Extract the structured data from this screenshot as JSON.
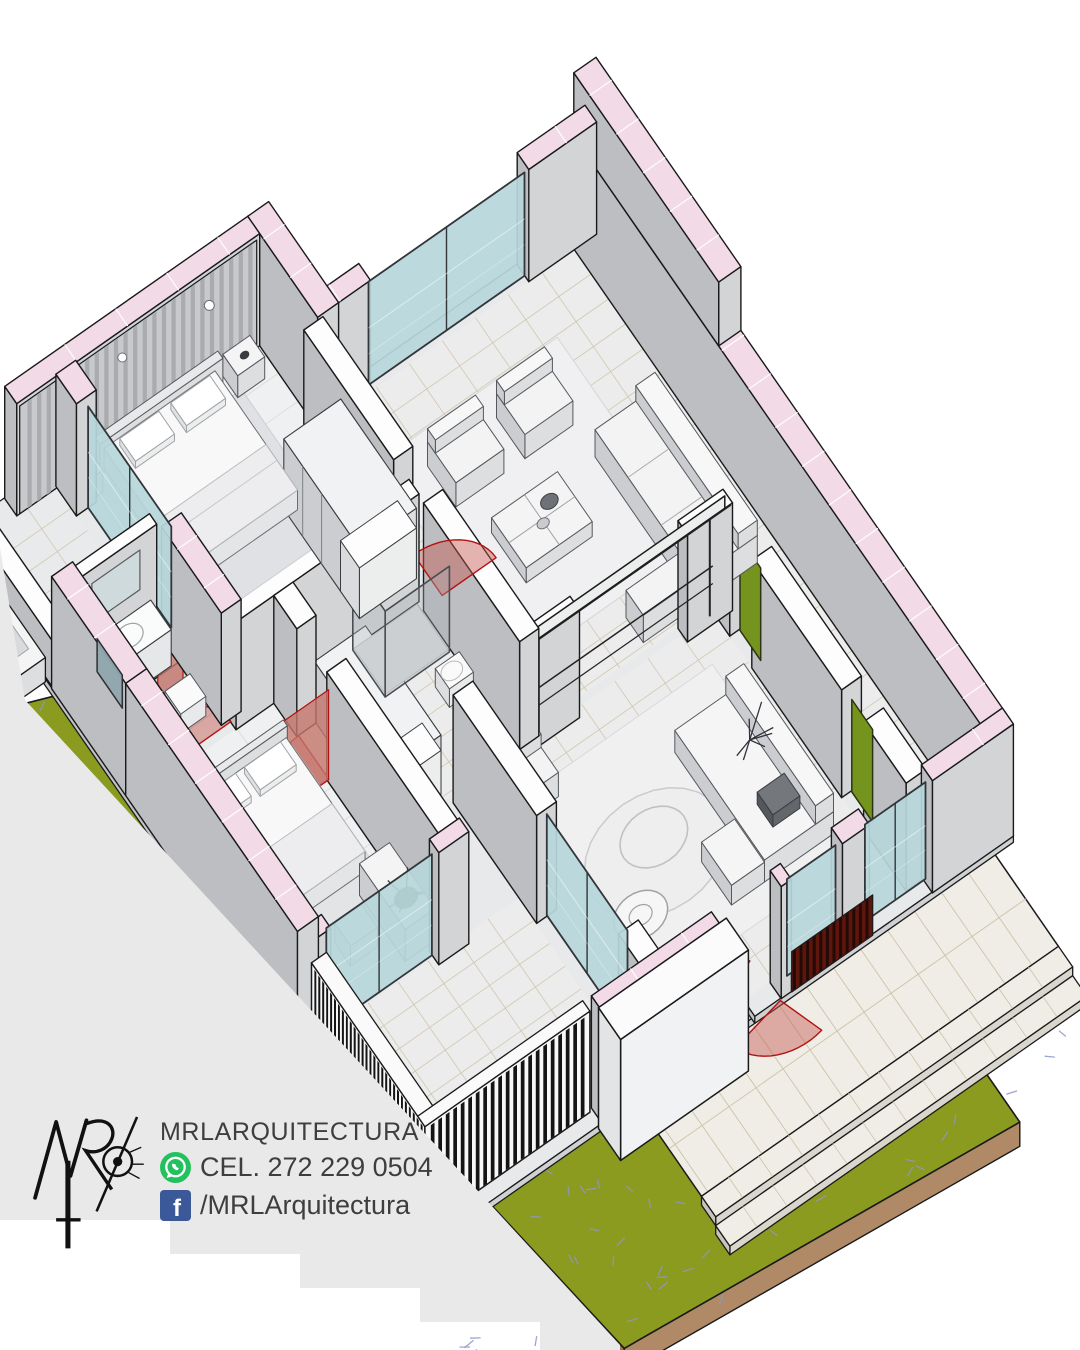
{
  "brand": {
    "logo_monogram": "MR",
    "name": "MRLARQUITECTURA",
    "phone": "CEL. 272 229 0504",
    "facebook": "/MRLArquitectura"
  },
  "icons": {
    "whatsapp_color": "#23c15e",
    "facebook_color": "#3b5998"
  },
  "colors": {
    "background": "#ffffff",
    "backdrop": "#e9e9e9",
    "lawn": "#8b9b1f",
    "grass_mark": "#8e97c8",
    "soil_sw": "#9d7352",
    "soil_se": "#b08966",
    "wall_cut": "#f2dbe7",
    "wall_cut_interior": "#fdfdfd",
    "wall_face_light": "#e3e4e6",
    "wall_face_mid": "#d2d4d6",
    "wall_face_dark": "#bcbec1",
    "floor": "#ececed",
    "floor_bedroom": "#eff0f1",
    "tile_grout": "#cdc3a9",
    "rug": "#f0f0f2",
    "glass": "#b7d6da",
    "glass_frame": "#32363a",
    "swing_fill": "rgba(198,88,80,0.45)",
    "swing_stroke": "#b31312",
    "door_wood": "#c8a25f",
    "door_red": "#c4766c",
    "door_green": "#75941e",
    "slat_dark": "#141414",
    "slat_bg": "#f7f7f7",
    "entry_slats_bg": "#5e150c",
    "entry_slats_stripe": "#220a06",
    "stone": "#efede6",
    "furn_top": "#f3f3f4",
    "furn_se": "#dddee0",
    "furn_sw": "#cbcdd0",
    "ink": "#1a1a1a",
    "text": "#3e3e3e"
  }
}
